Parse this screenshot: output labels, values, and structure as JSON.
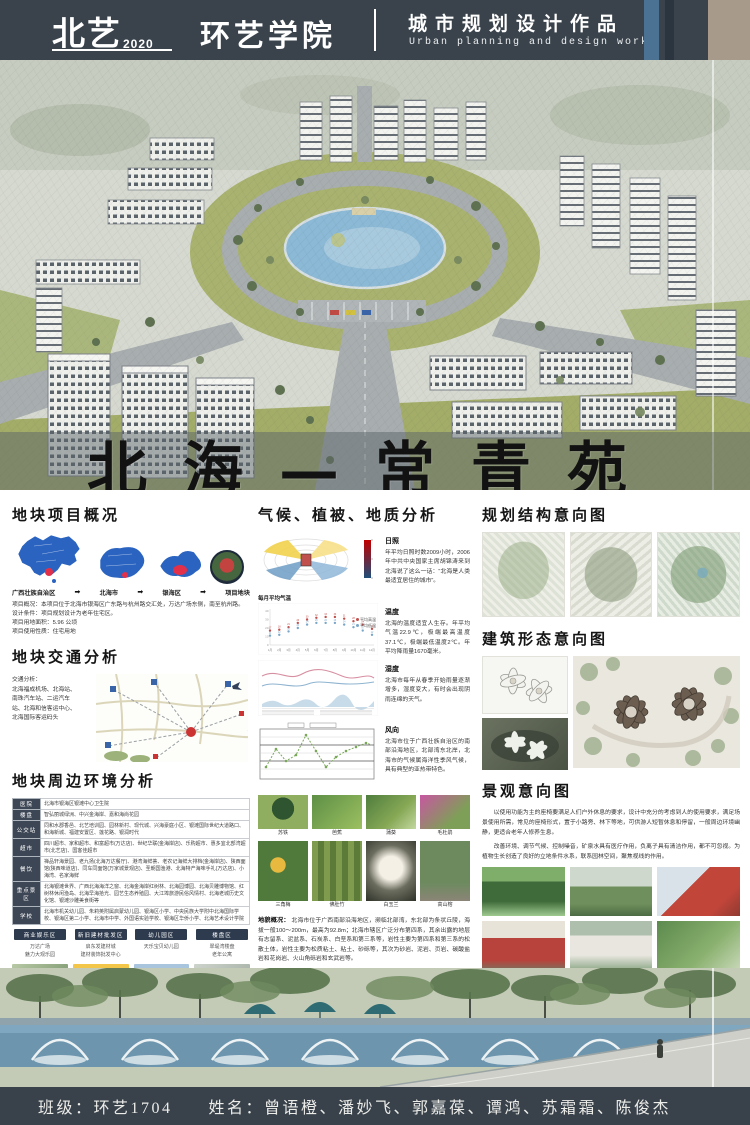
{
  "header": {
    "logo": "北艺",
    "year": "2020",
    "college": "环艺学院",
    "title_cn": "城市规划设计作品",
    "title_en": "Urban planning and design works"
  },
  "hero": {
    "title": "北海—常青苑"
  },
  "left": {
    "overview": {
      "heading": "地块项目概况",
      "arrow": "➡",
      "steps": [
        "广西壮族自治区",
        "北海市",
        "银海区",
        "项目地块"
      ],
      "info_lines": [
        "项目概况：本项目位于北海市银海区广东路与杭州路交汇处，万达广场东侧，南至杭州路。",
        "设计条件：项目规划设计为老年住宅区。",
        "项目用地面积：5.96 公顷",
        "项目使用性质：住宅用地"
      ]
    },
    "traffic": {
      "heading": "地块交通分析",
      "text": "交通分析：\n北海福成机场、北海站、\n南珠汽车站、二运汽车\n站、北海和信客运中心、\n北海国际客运码头"
    },
    "environment": {
      "heading": "地块周边环境分析",
      "table": [
        {
          "label": "医院",
          "text": "北海市银海区银滩中心卫生院"
        },
        {
          "label": "楼盘",
          "text": "智弘丽城绿洲、中兴金海岸、嘉和海尚花园"
        },
        {
          "label": "公交站",
          "text": "同和水郡香邑、北艺培训园、园林新村、现代城、兴海豪庭小区、银滩国际世纪大道路口、和海新城、福建安置区、莲花路、银润时代"
        },
        {
          "label": "超市",
          "text": "四川超市、家和超市、和富超市(万达店)、世纪华联(金海岸店)、乐购超市、惠多宜北部湾超市(北艺店)、国客佳超市"
        },
        {
          "label": "餐饮",
          "text": "禅品轩海景园、老九扬(北海万达餐厅)、港湾海鲜荟、老农记海鲜大排档(金海岸店)、陕西面馆(陕西味道店)、同车同面馆(万家城景观店)、圣朝国渔港、北海特产海味手礼(万达店)、小海湾、名家海鲜"
        },
        {
          "label": "重点景区",
          "text": "北海银滩世界、广西北海海洋之窗、北海金海岸红树林、北海园博园、北海贝雕博物馆、红树林休闲渔岛、北海早海拾光、园艺生态养殖园、大江埠旅游民俗风情村、北海老城历史文化馆、银滩沙雕美食街等"
        },
        {
          "label": "学校",
          "text": "北海市机关幼儿园、朱莉英附属启蒙幼儿园、银海区小学、中央民族大学附中北海国际学校、银海区第二小学、北海市中学、外国语实验学校、银海区华侨小学、北海艺术设计学院"
        }
      ],
      "zones": [
        "商业娱乐区",
        "新旧建材批发区",
        "幼儿园区",
        "楼盘区"
      ],
      "zone_captions": [
        [
          "万达广场",
          "魅力大观乐园"
        ],
        [
          "启东发建材城",
          "建材装饰批发中心"
        ],
        [
          "天乐宝贝幼儿园",
          ""
        ],
        [
          "翠堤湾楼盘",
          "老年公寓"
        ]
      ]
    }
  },
  "middle": {
    "heading": "气候、植被、地质分析",
    "sun": {
      "label": "日照",
      "text": "年平均日照时数2009小时，2006年中共中央国家主席胡锦涛来到北海说了这么一话：“北海是人类最适宜居住的城市”。"
    },
    "temp": {
      "label": "温度",
      "text": "北海的温度适宜人生存。年平均气温22.9℃，极端最高温度37.1℃，极端最低温度2℃。年平均降雨量1670毫米。"
    },
    "humidity": {
      "label": "湿度",
      "text": "北海市每年从春季开始雨量逐渐增多，湿度变大，有时会出现阴雨连绵的天气。"
    },
    "wind": {
      "label": "风向",
      "text": "北海市位于广西壮族自治区的南部沿海地区，北部湾东北岸，北海市的气候属海洋性季风气候，具有典型的亚热带特色。"
    },
    "plants": [
      "苏铁",
      "芭蕉",
      "蒲葵",
      "毛杜鹃",
      "三角梅",
      "佛肚竹",
      "白玉兰",
      "高山榕"
    ],
    "geo": {
      "heading": "地貌概况：",
      "text": "北海市位于广西南部沿海地区，濒临北部湾，东北部为条状丘陵，海拔一般100～200m，最高为92.8m；北海市辖区广泛分布第四系，其余出露的地层有志留系、泥盆系、石炭系、白垩系和第三系等，岩性主要为第四系和第三系的松散土体，岩性主要为松质粘土、粘土、砂砾等，其次为砂岩、泥岩、页岩、碳酸盐岩和花岗岩、火山角砾岩和玄武岩等。"
    },
    "hazard": {
      "heading": "地质灾害时间分布段：",
      "text": "崩塌、滑坡一般发生在每年的7～8月份，尤其是台风伴随强降雨的情况下，发生崩塌、滑坡的可能性最大。岩溶地面塌陷除人为因素外，主要发生的时间段在枯水期12月至翌年的1、2月份。"
    }
  },
  "right": {
    "s1_heading": "规划结构意向图",
    "s2_heading": "建筑形态意向图",
    "s3_heading": "景观意向图",
    "p1": "以使用功能为主的座椅要满足人们户外休息的要求，设计中充分的考虑到人的使用要求，满足场景使用所需，常见的座椅形式，置于小路旁、林下等地，可供游人短暂休息和停留，一般周边环境幽静，更适合老年人修养生息。",
    "p2": "改善环境、调节气候、控制噪音，矿泉水具有医疗作用，负离子具有清洁作用，都不可忽视。为植物生长创造了良好的立地条件水系，联系园林空间，聚焦视线的作用。"
  },
  "footer": {
    "class_label": "班级：环艺1704",
    "names_label": "姓名：曾语橙、潘妙飞、郭嘉葆、谭鸿、苏霜霜、陈俊杰"
  },
  "chart_data": {
    "type": "line",
    "title": "每月平均气温",
    "ylabel": "气温(℃)",
    "ylim": [
      0,
      40
    ],
    "categories": [
      "1月",
      "2月",
      "3月",
      "4月",
      "5月",
      "6月",
      "7月",
      "8月",
      "9月",
      "10月",
      "11月",
      "12月"
    ],
    "series": [
      {
        "name": "平均高温",
        "values": [
          17,
          18,
          21,
          26,
          30,
          32,
          33,
          33,
          31,
          28,
          24,
          19
        ]
      },
      {
        "name": "平均低温",
        "values": [
          11,
          12,
          16,
          20,
          24,
          26,
          26,
          26,
          24,
          21,
          17,
          12
        ]
      }
    ],
    "legend_position": "right",
    "grid": false
  }
}
